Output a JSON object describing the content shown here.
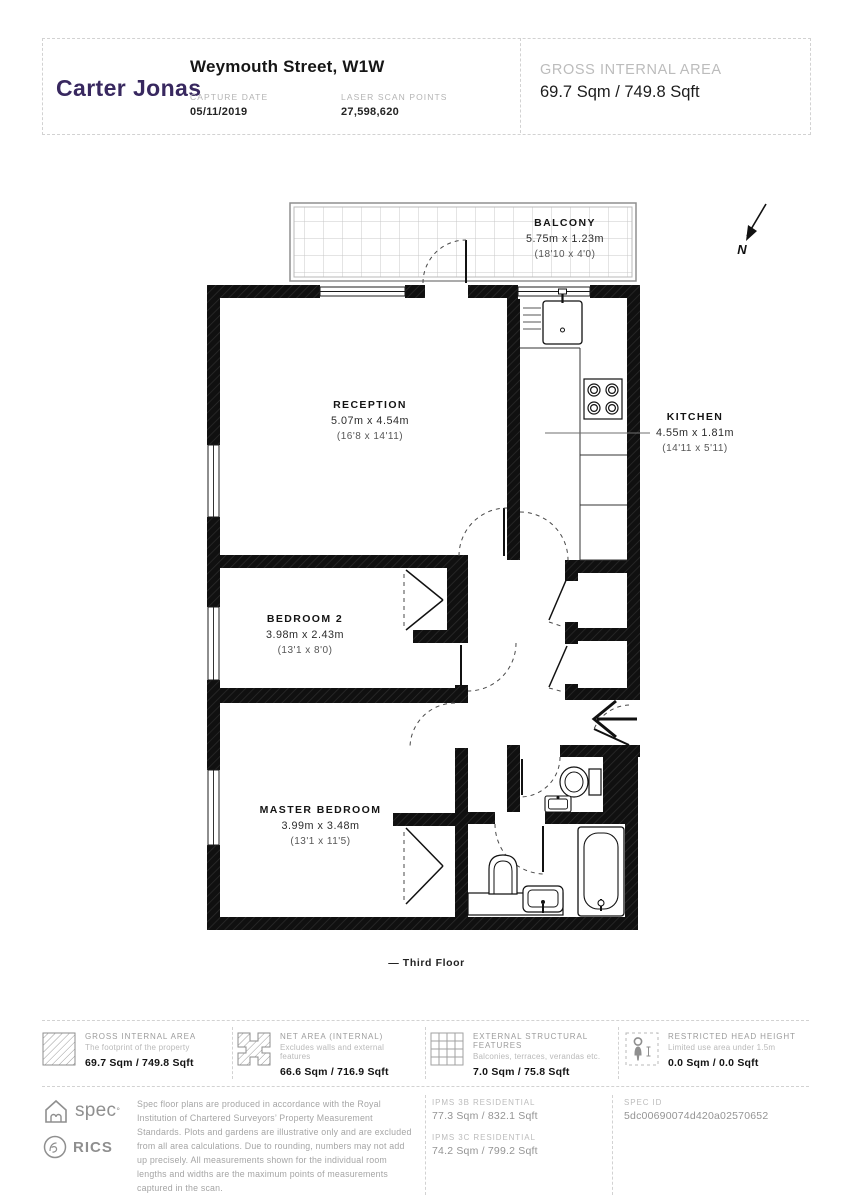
{
  "header": {
    "brand": "Carter Jonas",
    "title": "Weymouth Street, W1W",
    "capture_date_label": "CAPTURE DATE",
    "capture_date": "05/11/2019",
    "laser_label": "LASER SCAN POINTS",
    "laser_points": "27,598,620",
    "gia_label": "GROSS INTERNAL AREA",
    "gia_value": "69.7 Sqm / 749.8 Sqft"
  },
  "plan": {
    "north_label": "N",
    "floor_label": "— Third Floor",
    "rooms": {
      "balcony": {
        "name": "BALCONY",
        "dims_m": "5.75m x 1.23m",
        "dims_ft": "(18'10 x 4'0)"
      },
      "reception": {
        "name": "RECEPTION",
        "dims_m": "5.07m x 4.54m",
        "dims_ft": "(16'8 x 14'11)"
      },
      "kitchen": {
        "name": "KITCHEN",
        "dims_m": "4.55m x 1.81m",
        "dims_ft": "(14'11 x 5'11)"
      },
      "bedroom2": {
        "name": "BEDROOM 2",
        "dims_m": "3.98m x 2.43m",
        "dims_ft": "(13'1 x 8'0)"
      },
      "master": {
        "name": "MASTER BEDROOM",
        "dims_m": "3.99m x 3.48m",
        "dims_ft": "(13'1 x 11'5)"
      }
    }
  },
  "legend": {
    "items": [
      {
        "icon": "diagonal-hatch",
        "title": "GROSS INTERNAL AREA",
        "subtitle": "The footprint of the property",
        "value": "69.7 Sqm / 749.8 Sqft"
      },
      {
        "icon": "net-hatch",
        "title": "NET AREA (INTERNAL)",
        "subtitle": "Excludes walls and external features",
        "value": "66.6 Sqm / 716.9 Sqft"
      },
      {
        "icon": "grid",
        "title": "EXTERNAL STRUCTURAL FEATURES",
        "subtitle": "Balconies, terraces, verandas etc.",
        "value": "7.0 Sqm / 75.8 Sqft"
      },
      {
        "icon": "person-dashed",
        "title": "RESTRICTED HEAD HEIGHT",
        "subtitle": "Limited use area under 1.5m",
        "value": "0.0 Sqm / 0.0 Sqft"
      }
    ]
  },
  "footer": {
    "spec_label": "spec",
    "spec_mark": "°",
    "rics_label": "RICS",
    "disclaimer": "Spec floor plans are produced in accordance with the Royal Institution of Chartered Surveyors’ Property Measurement Standards. Plots and gardens are illustrative only and are excluded from all area calculations. Due to rounding, numbers may not add up precisely. All measurements shown for the individual room lengths and widths are the maximum points of measurements captured in the scan.",
    "ipms_3b_label": "IPMS 3B RESIDENTIAL",
    "ipms_3b_value": "77.3 Sqm / 832.1 Sqft",
    "ipms_3c_label": "IPMS 3C RESIDENTIAL",
    "ipms_3c_value": "74.2 Sqm / 799.2 Sqft",
    "spec_id_label": "SPEC ID",
    "spec_id_value": "5dc00690074d420a02570652"
  },
  "colors": {
    "brand_purple": "#38285f",
    "wall_black": "#101010",
    "muted_gray": "#a5a5a5"
  }
}
